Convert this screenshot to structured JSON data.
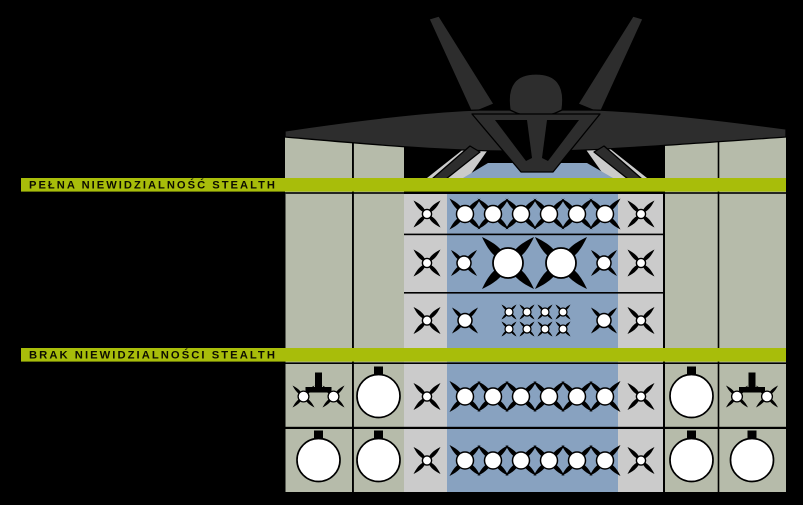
{
  "diagram": {
    "subject": "f22-weapons-loadout-diagram",
    "aircraft": "f22-front-silhouette"
  },
  "colors": {
    "background": "#000000",
    "band_green": "#a8bd0a",
    "station_olive": "#b6bbaa",
    "station_gray": "#cbcbcb",
    "bay_blue": "#88a2c0",
    "jet_dark": "#2d2d2d",
    "weapon_white": "#ffffff",
    "line_black": "#000000"
  },
  "bands": {
    "stealth": {
      "label": "PEŁNA NIEWIDZIALNOŚĆ STEALTH"
    },
    "no_stealth": {
      "label": "BRAK NIEWIDZIALNOŚCI STEALTH"
    }
  },
  "sections": [
    {
      "band": "stealth",
      "rows": [
        {
          "id": "stealth-1",
          "cells": [
            {
              "station": "bay-side-left",
              "items": [
                {
                  "icon": "missile-small",
                  "count": 1
                }
              ]
            },
            {
              "station": "bay-main",
              "items": [
                {
                  "icon": "missile-medium",
                  "count": 6
                }
              ]
            },
            {
              "station": "bay-side-right",
              "items": [
                {
                  "icon": "missile-small",
                  "count": 1
                }
              ]
            }
          ]
        },
        {
          "id": "stealth-2",
          "cells": [
            {
              "station": "bay-side-left",
              "items": [
                {
                  "icon": "missile-small",
                  "count": 1
                }
              ]
            },
            {
              "station": "bay-main",
              "items": [
                {
                  "icon": "missile-medium-short",
                  "count": 1
                },
                {
                  "icon": "bomb-heavy",
                  "count": 1
                },
                {
                  "icon": "bomb-heavy",
                  "count": 1
                },
                {
                  "icon": "missile-medium-short",
                  "count": 1
                }
              ]
            },
            {
              "station": "bay-side-right",
              "items": [
                {
                  "icon": "missile-small",
                  "count": 1
                }
              ]
            }
          ]
        },
        {
          "id": "stealth-3",
          "cells": [
            {
              "station": "bay-side-left",
              "items": [
                {
                  "icon": "missile-small",
                  "count": 1
                }
              ]
            },
            {
              "station": "bay-main",
              "items": [
                {
                  "icon": "missile-medium-short",
                  "count": 1
                },
                {
                  "icon": "bomb-small",
                  "count": 8,
                  "layout": "grid-4x2"
                },
                {
                  "icon": "missile-medium-short",
                  "count": 1
                }
              ]
            },
            {
              "station": "bay-side-right",
              "items": [
                {
                  "icon": "missile-small",
                  "count": 1
                }
              ]
            }
          ]
        }
      ]
    },
    {
      "band": "no_stealth",
      "rows": [
        {
          "id": "open-1",
          "cells": [
            {
              "station": "wing-outer-left",
              "items": [
                {
                  "icon": "twin-missile-rail",
                  "count": 1
                }
              ]
            },
            {
              "station": "wing-tank-left",
              "items": [
                {
                  "icon": "fuel-tank",
                  "count": 1
                }
              ]
            },
            {
              "station": "bay-side-left",
              "items": [
                {
                  "icon": "missile-small",
                  "count": 1
                }
              ]
            },
            {
              "station": "bay-main",
              "items": [
                {
                  "icon": "missile-medium",
                  "count": 6
                }
              ]
            },
            {
              "station": "bay-side-right",
              "items": [
                {
                  "icon": "missile-small",
                  "count": 1
                }
              ]
            },
            {
              "station": "wing-tank-right",
              "items": [
                {
                  "icon": "fuel-tank",
                  "count": 1
                }
              ]
            },
            {
              "station": "wing-outer-right",
              "items": [
                {
                  "icon": "twin-missile-rail",
                  "count": 1
                }
              ]
            }
          ]
        },
        {
          "id": "open-2",
          "cells": [
            {
              "station": "wing-outer-left",
              "items": [
                {
                  "icon": "fuel-tank",
                  "count": 1
                }
              ]
            },
            {
              "station": "wing-tank-left",
              "items": [
                {
                  "icon": "fuel-tank",
                  "count": 1
                }
              ]
            },
            {
              "station": "bay-side-left",
              "items": [
                {
                  "icon": "missile-small",
                  "count": 1
                }
              ]
            },
            {
              "station": "bay-main",
              "items": [
                {
                  "icon": "missile-medium",
                  "count": 6
                }
              ]
            },
            {
              "station": "bay-side-right",
              "items": [
                {
                  "icon": "missile-small",
                  "count": 1
                }
              ]
            },
            {
              "station": "wing-tank-right",
              "items": [
                {
                  "icon": "fuel-tank",
                  "count": 1
                }
              ]
            },
            {
              "station": "wing-outer-right",
              "items": [
                {
                  "icon": "fuel-tank",
                  "count": 1
                }
              ]
            }
          ]
        }
      ]
    }
  ]
}
